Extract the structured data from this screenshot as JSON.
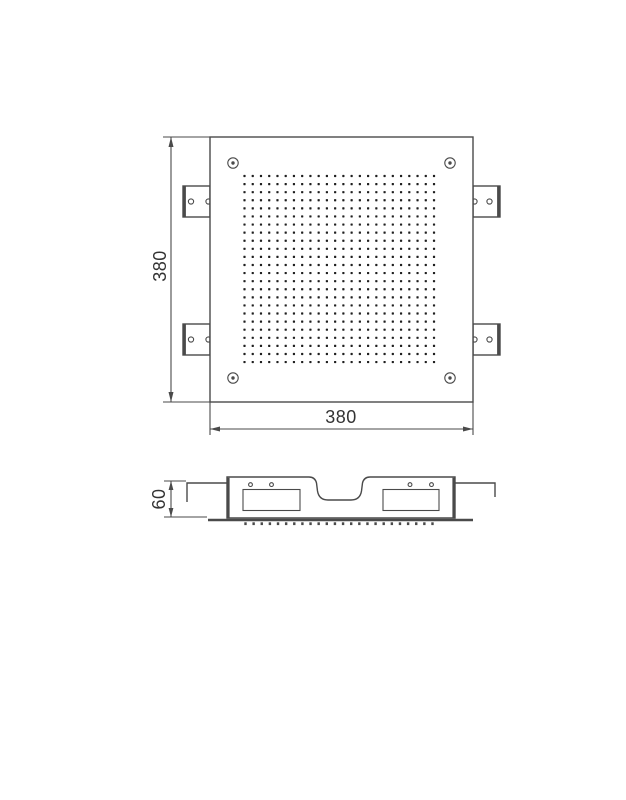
{
  "drawing": {
    "views": {
      "top": {
        "width_label": "380",
        "height_label": "380",
        "nozzle_grid": {
          "rows": 24,
          "cols": 24
        },
        "corner_screw_count": 4,
        "mounting_bracket_count": 4,
        "bracket_hole_count": 2
      },
      "side": {
        "height_label": "60",
        "nozzle_count": 24,
        "chamber_count": 2,
        "clip_count": 2
      }
    },
    "colors": {
      "line": "#4a4a4a",
      "text": "#333333",
      "dot": "#1f1f1f",
      "background": "#ffffff"
    }
  }
}
